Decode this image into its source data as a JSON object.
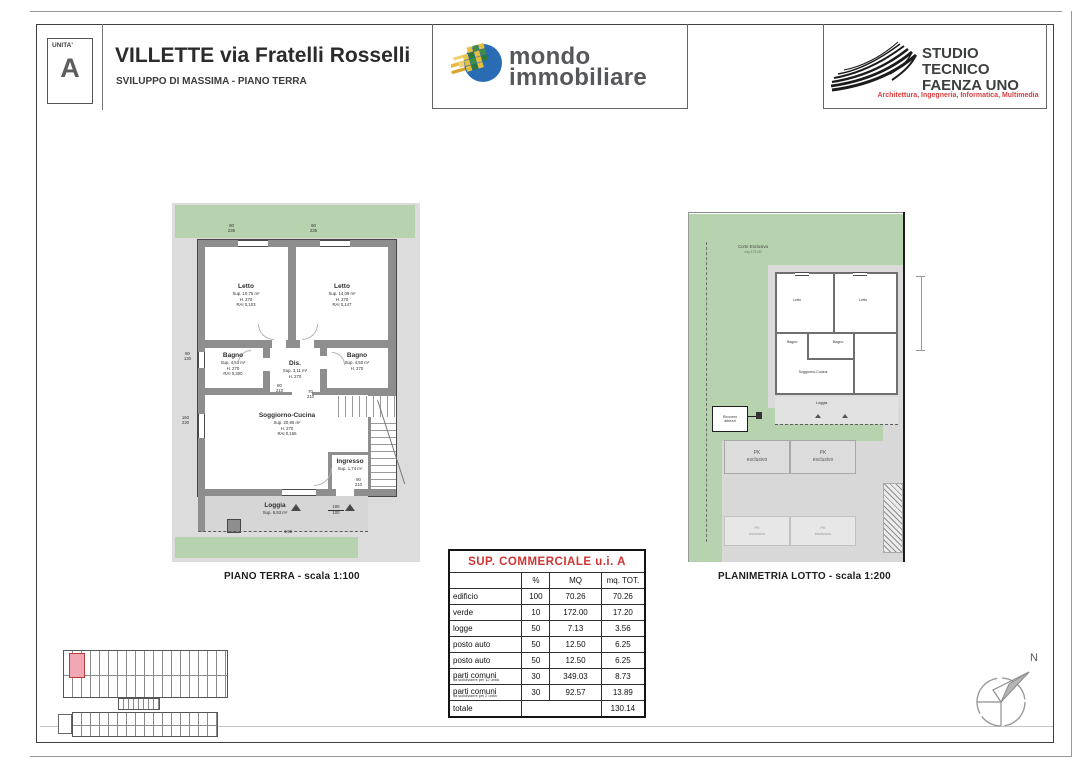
{
  "header": {
    "unit_label": "UNITA'",
    "unit_value": "A",
    "title": "VILLETTE via Fratelli Rosselli",
    "subtitle": "SVILUPPO DI MASSIMA - PIANO TERRA",
    "mondo": {
      "word1": "mondo",
      "word2": "immobiliare"
    },
    "studio": {
      "line1": "STUDIO TECNICO",
      "line2": "FAENZA UNO",
      "tagline": "Architettura, Ingegneria, Informatica, Multimedia"
    }
  },
  "floor_plan": {
    "caption": "PIANO TERRA - scala 1:100",
    "rooms": [
      {
        "name": "Letto",
        "l1": "Sup. 10,75 m²",
        "l2": "H. 270",
        "l3": "RAI 0,103"
      },
      {
        "name": "Letto",
        "l1": "Sup. 14,09 m²",
        "l2": "H. 270",
        "l3": "RAI 0,147"
      },
      {
        "name": "Bagno",
        "l1": "Sup. 4,51 m²",
        "l2": "H. 270",
        "l3": "RAI 0,200"
      },
      {
        "name": "Dis.",
        "l1": "Sup. 3,11 m²",
        "l2": "H. 270",
        "l3": ""
      },
      {
        "name": "Bagno",
        "l1": "Sup. 4,50 m²",
        "l2": "H. 270",
        "l3": ""
      },
      {
        "name": "Soggiorno-Cucina",
        "l1": "Sup. 20,90 m²",
        "l2": "H. 270",
        "l3": "RAI 0,156"
      },
      {
        "name": "Ingresso",
        "l1": "Sup. 1,74 m²",
        "l2": "",
        "l3": ""
      },
      {
        "name": "Loggia",
        "l1": "Sup. 6,93 m²",
        "l2": "",
        "l3": ""
      }
    ],
    "dims": {
      "w1": "90 235",
      "w2": "90 235",
      "w3": "80 130",
      "w4": "160 230",
      "d1": "80 210",
      "d2": "70 210",
      "d3": "90 210",
      "frac_top": "100",
      "frac_bottom": "100",
      "length": "4,55"
    }
  },
  "lot_plan": {
    "caption": "PLANIMETRIA LOTTO - scala 1:200",
    "corte_line1": "Corte Esclusiva",
    "corte_line2": "mq 172,00",
    "pk_line1": "PK",
    "pk_line2": "esclusivo",
    "shed_label": "Ricovero attrezzi",
    "house_labels": {
      "letto1": "Letto",
      "letto2": "Letto",
      "bagno1": "Bagno",
      "bagno2": "Bagno",
      "soggiorno": "Soggiorno-Cucina",
      "loggia": "Loggia"
    }
  },
  "table": {
    "title": "SUP. COMMERCIALE u.i. A",
    "columns": {
      "c1": "",
      "c2": "%",
      "c3": "MQ",
      "c4": "mq. TOT."
    },
    "rows": [
      {
        "label": "edificio",
        "note": "",
        "pct": "100",
        "mq": "70.26",
        "tot": "70.26"
      },
      {
        "label": "verde",
        "note": "",
        "pct": "10",
        "mq": "172.00",
        "tot": "17.20"
      },
      {
        "label": "logge",
        "note": "",
        "pct": "50",
        "mq": "7.13",
        "tot": "3.56"
      },
      {
        "label": "posto auto",
        "note": "",
        "pct": "50",
        "mq": "12.50",
        "tot": "6.25"
      },
      {
        "label": "posto auto",
        "note": "",
        "pct": "50",
        "mq": "12.50",
        "tot": "6.25"
      },
      {
        "label": "parti comuni",
        "note": "da suddividere per 12 unità",
        "pct": "30",
        "mq": "349.03",
        "tot": "8.73"
      },
      {
        "label": "parti comuni",
        "note": "da suddividere per 2 unità",
        "pct": "30",
        "mq": "92.57",
        "tot": "13.89"
      },
      {
        "label": "totale",
        "note": "",
        "pct": "",
        "mq": "",
        "tot": "130.14"
      }
    ]
  },
  "compass_label": "N",
  "colors": {
    "green": "#b7d2ae",
    "scan_gray": "#dcdcdc",
    "wall_gray": "#8e8e8e",
    "accent_red": "#cf3333",
    "tagline_red": "#d54040",
    "logo_blue": "#2a6cb3",
    "logo_green": "#3f8f3f",
    "logo_yellow": "#e4bf3e",
    "highlight_pink": "#f0a9b4",
    "highlight_red": "#bb3a3a"
  }
}
